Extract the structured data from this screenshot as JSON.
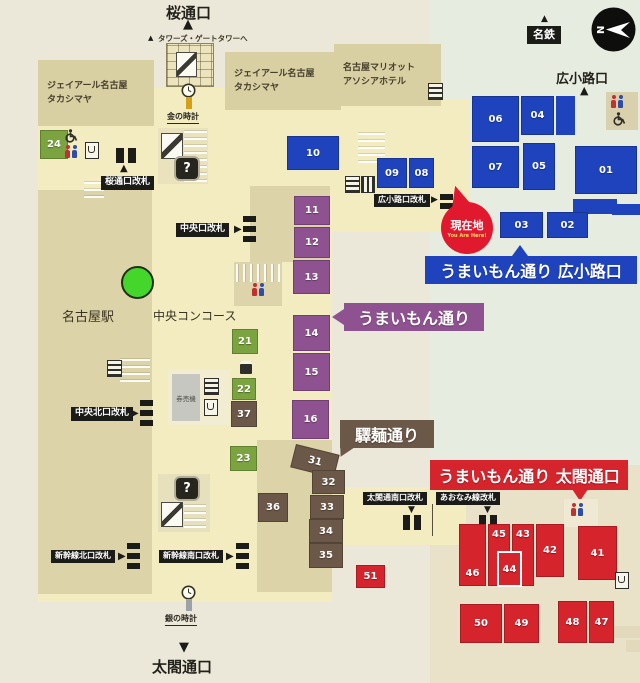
{
  "exits": {
    "north": "桜通口",
    "east": "広小路口",
    "south": "太閤通口",
    "meitetsu": "名鉄",
    "compass_n": "N"
  },
  "buildings": {
    "takashimaya_line1": "ジェイアール名古屋",
    "takashimaya_line2": "タカシマヤ",
    "marriott_line1": "名古屋マリオット",
    "marriott_line2": "アソシアホテル",
    "station": "名古屋駅",
    "concourse": "中央コンコース",
    "ticket_machines": "券売機",
    "towers_note": "タワーズ・ゲートタワーへ"
  },
  "landmarks": {
    "gold_clock": "金の時計",
    "silver_clock": "銀の時計",
    "you_are_here": "現在地",
    "you_are_here_en": "You Are Here!",
    "info_mark": "?"
  },
  "gates": {
    "sakura": "桜通口改札",
    "chuo": "中央口改札",
    "chuo_north": "中央北口改札",
    "shinkansen_north": "新幹線北口改札",
    "shinkansen_south": "新幹線南口改札",
    "hirokoji": "広小路口改札",
    "taiko_south": "太閤通南口改札",
    "aonami": "あおなみ線改札"
  },
  "streets": {
    "umaimon_hirokoji": "うまいもん通り 広小路口",
    "umaimon": "うまいもん通り",
    "ekimen": "驛麺通り",
    "umaimon_taiko": "うまいもん通り 太閤通口"
  },
  "units": {
    "u01": "01",
    "u02": "02",
    "u03": "03",
    "u04": "04",
    "u05": "05",
    "u06": "06",
    "u07": "07",
    "u08": "08",
    "u09": "09",
    "u10": "10",
    "u11": "11",
    "u12": "12",
    "u13": "13",
    "u14": "14",
    "u15": "15",
    "u16": "16",
    "u21": "21",
    "u22": "22",
    "u23": "23",
    "u24": "24",
    "u31": "31",
    "u32": "32",
    "u33": "33",
    "u34": "34",
    "u35": "35",
    "u36": "36",
    "u37": "37",
    "u41": "41",
    "u42": "42",
    "u43": "43",
    "u44": "44",
    "u45": "45",
    "u46": "46",
    "u47": "47",
    "u48": "48",
    "u49": "49",
    "u50": "50",
    "u51": "51"
  },
  "legend_colors": {
    "umaimon_hirokoji_blue": "#1e43bd",
    "umaimon_purple": "#8f5291",
    "ekimen_brown": "#6b5848",
    "umaimon_taiko_red": "#d6242d",
    "green_shops": "#7ba33f",
    "you_are_here_red": "#e1192e"
  }
}
